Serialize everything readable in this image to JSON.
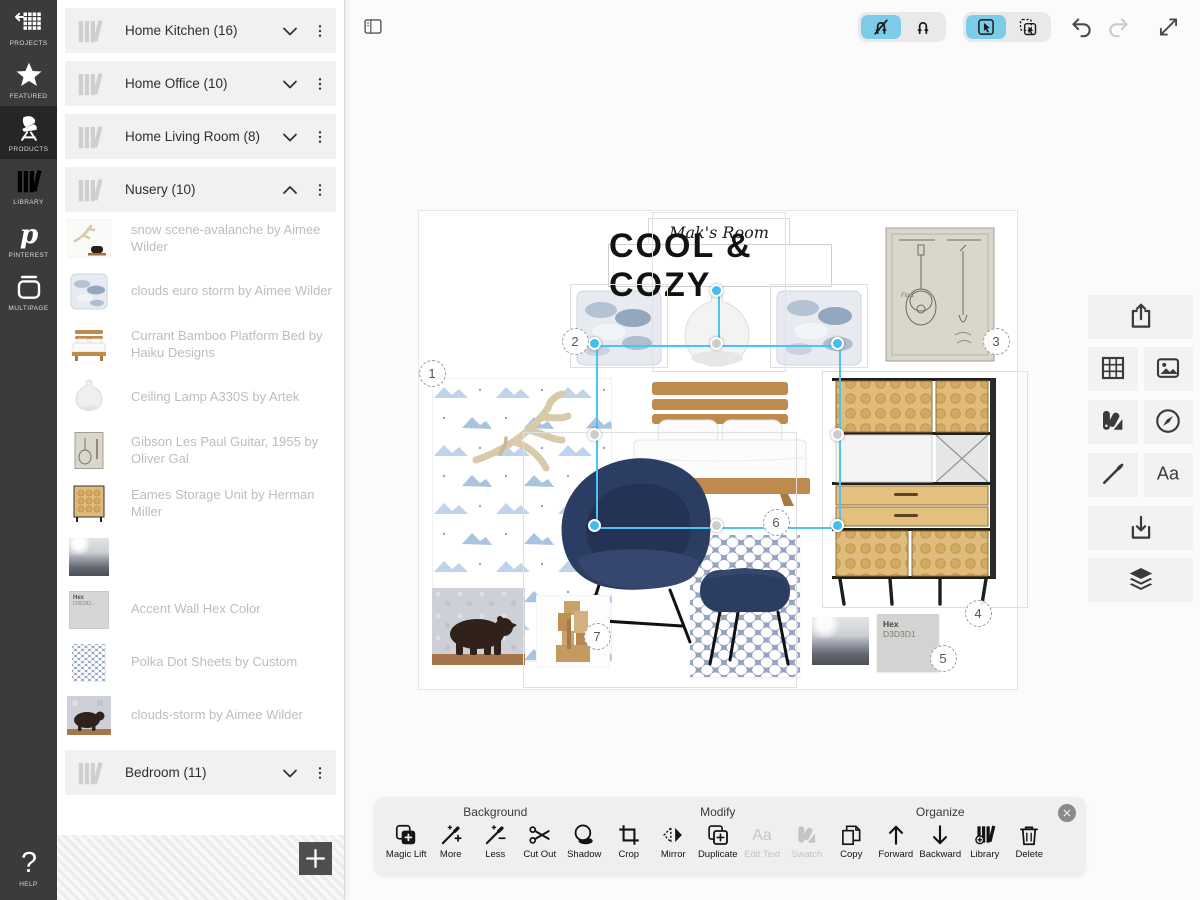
{
  "nav_rail": {
    "items": [
      {
        "id": "projects",
        "label": "PROJECTS",
        "icon": "grid-back-icon",
        "selected": false
      },
      {
        "id": "featured",
        "label": "FEATURED",
        "icon": "star-icon",
        "selected": false
      },
      {
        "id": "products",
        "label": "PRODUCTS",
        "icon": "chair-icon",
        "selected": true
      },
      {
        "id": "library",
        "label": "LIBRARY",
        "icon": "books-icon",
        "selected": false
      },
      {
        "id": "pinterest",
        "label": "PINTEREST",
        "icon": "pinterest-icon",
        "selected": false
      },
      {
        "id": "multipage",
        "label": "MULTIPAGE",
        "icon": "multipage-icon",
        "selected": false
      }
    ],
    "help": {
      "id": "help",
      "label": "HELP",
      "icon": "question-icon"
    }
  },
  "library_panel": {
    "folders_top": [
      {
        "label": "Home Kitchen (16)",
        "expanded": false
      },
      {
        "label": "Home Office (10)",
        "expanded": false
      },
      {
        "label": "Home Living Room (8)",
        "expanded": false
      },
      {
        "label": "Nusery (10)",
        "expanded": true
      }
    ],
    "products": [
      {
        "label": "snow scene-avalanche by Aimee Wilder",
        "thumb": "snow"
      },
      {
        "label": "clouds euro storm by Aimee Wilder",
        "thumb": "pillow"
      },
      {
        "label": "Currant Bamboo Platform Bed by Haiku Designs",
        "thumb": "bed"
      },
      {
        "label": "Ceiling Lamp A330S by Artek",
        "thumb": "lamp"
      },
      {
        "label": "Gibson Les Paul Guitar, 1955 by Oliver Gal",
        "thumb": "guitar"
      },
      {
        "label": "Eames Storage Unit by Herman Miller",
        "thumb": "storage"
      },
      {
        "label": "",
        "thumb": "landscape"
      },
      {
        "label": "Accent Wall Hex Color",
        "thumb": "hex"
      },
      {
        "label": "Polka Dot Sheets by Custom",
        "thumb": "polka"
      },
      {
        "label": "clouds-storm by Aimee Wilder",
        "thumb": "bear"
      }
    ],
    "folders_bottom": [
      {
        "label": "Bedroom (11)",
        "expanded": false
      }
    ]
  },
  "top_toolbar": {
    "segmented": [
      {
        "name": "snap-toggle",
        "segments": [
          {
            "name": "snap-off-button",
            "icon": "magnet-off-icon",
            "selected": true
          },
          {
            "name": "snap-on-button",
            "icon": "magnet-icon",
            "selected": false
          }
        ]
      },
      {
        "name": "select-mode",
        "segments": [
          {
            "name": "single-select-button",
            "icon": "select-cursor-icon",
            "selected": true
          },
          {
            "name": "multi-select-button",
            "icon": "multi-select-icon",
            "selected": false
          }
        ]
      }
    ],
    "actions": [
      {
        "name": "undo-button",
        "icon": "undo-icon",
        "enabled": true,
        "left": 723
      },
      {
        "name": "redo-button",
        "icon": "redo-icon",
        "enabled": false,
        "left": 760
      },
      {
        "name": "fullscreen-button",
        "icon": "expand-icon",
        "enabled": true,
        "left": 810
      }
    ]
  },
  "right_toolbar": {
    "rows": [
      [
        {
          "name": "share-button",
          "icon": "share-icon"
        }
      ],
      [
        {
          "name": "templates-button",
          "icon": "grid-template-icon"
        },
        {
          "name": "images-button",
          "icon": "image-icon"
        }
      ],
      [
        {
          "name": "swatches-button",
          "icon": "swatches-icon"
        },
        {
          "name": "browse-button",
          "icon": "compass-icon"
        }
      ],
      [
        {
          "name": "draw-button",
          "icon": "pen-icon"
        },
        {
          "name": "text-button",
          "icon": "text-icon"
        }
      ],
      [
        {
          "name": "import-button",
          "icon": "import-icon"
        }
      ],
      [
        {
          "name": "layers-button",
          "icon": "layers-icon"
        }
      ]
    ],
    "tops": [
      295,
      347,
      400,
      453,
      506,
      558
    ]
  },
  "bottom_toolbar": {
    "groups": [
      {
        "label": "Background",
        "buttons": [
          {
            "label": "Magic Lift",
            "icon": "magic-lift-icon",
            "disabled": false
          },
          {
            "label": "More",
            "icon": "wand-plus-icon",
            "disabled": false
          },
          {
            "label": "Less",
            "icon": "wand-minus-icon",
            "disabled": false
          },
          {
            "label": "Cut Out",
            "icon": "scissors-icon",
            "disabled": false
          },
          {
            "label": "Shadow",
            "icon": "shadow-icon",
            "disabled": false
          }
        ]
      },
      {
        "label": "Modify",
        "buttons": [
          {
            "label": "Crop",
            "icon": "crop-icon",
            "disabled": false
          },
          {
            "label": "Mirror",
            "icon": "mirror-icon",
            "disabled": false
          },
          {
            "label": "Duplicate",
            "icon": "duplicate-icon",
            "disabled": false
          },
          {
            "label": "Edit Text",
            "icon": "edit-text-icon",
            "disabled": true
          },
          {
            "label": "Swatch",
            "icon": "swatch-icon",
            "disabled": true
          }
        ]
      },
      {
        "label": "Organize",
        "buttons": [
          {
            "label": "Copy",
            "icon": "copy-icon",
            "disabled": false
          },
          {
            "label": "Forward",
            "icon": "arrow-up-icon",
            "disabled": false
          },
          {
            "label": "Backward",
            "icon": "arrow-down-icon",
            "disabled": false
          },
          {
            "label": "Library",
            "icon": "library-add-icon",
            "disabled": false
          },
          {
            "label": "Delete",
            "icon": "trash-icon",
            "disabled": false
          }
        ]
      }
    ]
  },
  "board": {
    "subtitle": "Mak's Room",
    "title": "COOL & COZY",
    "hex_swatch": {
      "label": "Hex",
      "value": "D3D3D1"
    },
    "markers": [
      {
        "n": "1",
        "x": 87,
        "y": 373
      },
      {
        "n": "2",
        "x": 230,
        "y": 341
      },
      {
        "n": "3",
        "x": 651,
        "y": 341
      },
      {
        "n": "4",
        "x": 633,
        "y": 613
      },
      {
        "n": "5",
        "x": 598,
        "y": 658
      },
      {
        "n": "6",
        "x": 431,
        "y": 522
      },
      {
        "n": "7",
        "x": 252,
        "y": 636
      }
    ]
  },
  "colors": {
    "accent_blue": "#7CCBE9",
    "selection_blue": "#3FBFF0",
    "rail_bg": "#3B3B3B",
    "hex_swatch_fill": "#D3D3D1"
  }
}
